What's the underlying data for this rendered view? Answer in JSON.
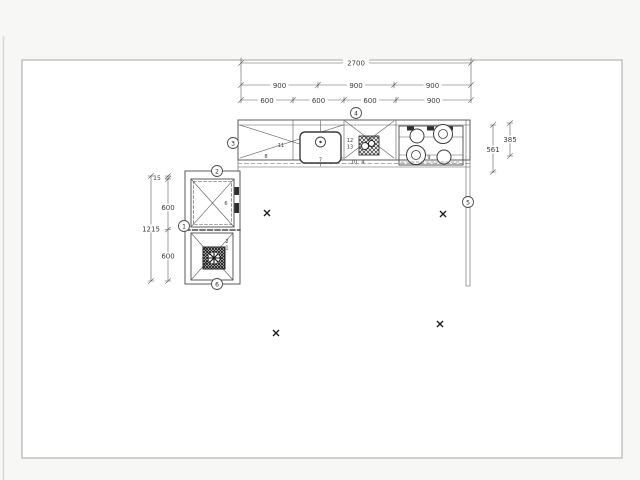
{
  "window": {
    "background": "#f7f7f5",
    "edge_line_color": "#d8d8d8"
  },
  "sheet": {
    "fill": "#ffffff",
    "border_color": "#a6a6a6"
  },
  "plan": {
    "ink_color": "#4a4a4a",
    "dims": {
      "top_overall": "2700",
      "top_row2": [
        "900",
        "900",
        "900"
      ],
      "top_row3": [
        "600",
        "600",
        "600",
        "900"
      ],
      "left_overall": "1215",
      "left_chain": [
        "15",
        "600",
        "600"
      ],
      "right_depth_counter": "561",
      "right_depth_upper": "385"
    },
    "balloons": {
      "counter_run": "4",
      "counter_left_end": "3",
      "left_unit_top": "2",
      "left_unit_side": "1",
      "left_unit_bottom": "6",
      "right_wall": "5"
    },
    "items": {
      "counter_cabinet": "11",
      "counter_base": "8",
      "sink": "7",
      "hob_upper": "12",
      "hob_lower": "13",
      "hob_front_left": "10",
      "hob_front": "4",
      "cooktop": "9",
      "wall_cabinet": "6",
      "tall_unit_upper": "2",
      "tall_unit_lower": "1"
    }
  }
}
